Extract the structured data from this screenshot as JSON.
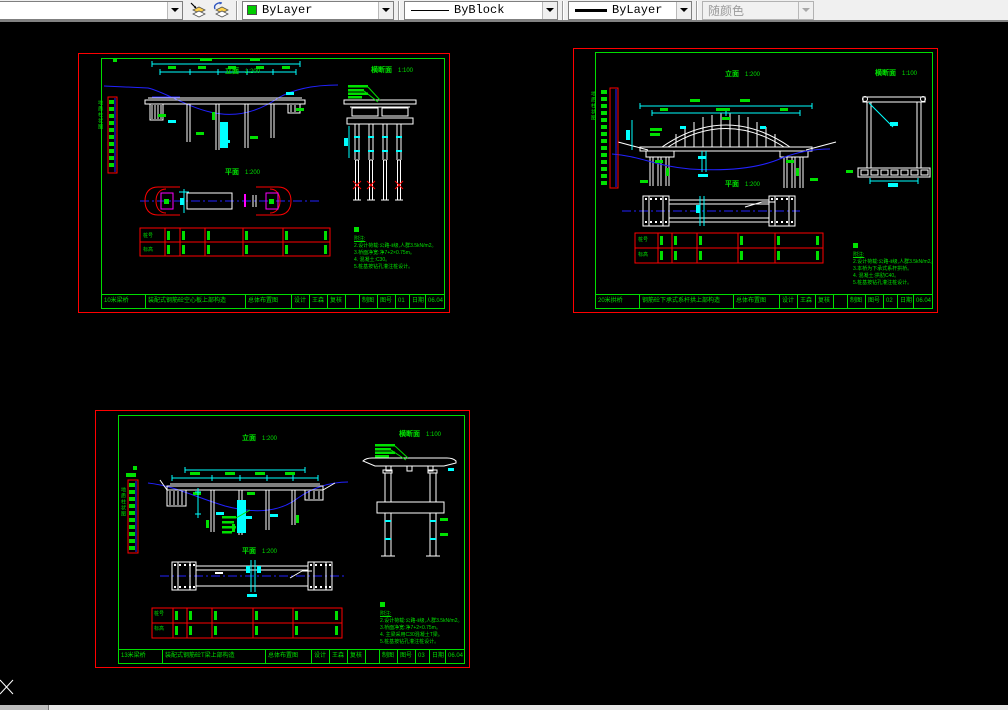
{
  "toolbar": {
    "layer_dropdown": {
      "value": ""
    },
    "color_dropdown": {
      "value": "ByLayer",
      "swatch": "#00CC00"
    },
    "linetype_dropdown": {
      "value": "ByBlock"
    },
    "lineweight_dropdown": {
      "value": "ByLayer"
    },
    "plotstyle_dropdown": {
      "value": "随颜色",
      "disabled": "true"
    }
  },
  "sheets": [
    {
      "elevation_title": "立面",
      "elevation_scale": "1:200",
      "plan_title": "平面",
      "plan_scale": "1:200",
      "section_title": "横断面",
      "section_scale": "1:100",
      "scalebar_text": "地质柱状图",
      "table_row1": "桩号",
      "table_row2": "标高",
      "notes_heading": "附注:",
      "notes": [
        "2.设计荷载:公路-Ⅱ级,人群3.5kN/m2。",
        "3.桥面净宽:净7+2×0.75m。",
        "4.  混凝土:C30。",
        "5.桩基按钻孔灌注桩设计。"
      ],
      "titleblock": {
        "c1": "10米梁桥",
        "c2": "装配式钢筋砼空心板上部构造",
        "c3": "总体布置图",
        "c4": "设计",
        "c5": "王森",
        "c6": "复核",
        "c7": "制图",
        "c8": "图号",
        "c9": "01",
        "c10": "日期",
        "c11": "06.04"
      }
    },
    {
      "elevation_title": "立面",
      "elevation_scale": "1:200",
      "plan_title": "平面",
      "plan_scale": "1:200",
      "section_title": "横断面",
      "section_scale": "1:100",
      "scalebar_text": "地质柱状图",
      "table_row1": "桩号",
      "table_row2": "标高",
      "notes_heading": "附注:",
      "notes": [
        "2.设计荷载:公路-Ⅱ级,人群3.5kN/m2。",
        "3.本桥为下承式系杆拱桥。",
        "4.  混凝土:拱肋C40。",
        "5.桩基按钻孔灌注桩设计。"
      ],
      "titleblock": {
        "c1": "20米拱桥",
        "c2": "钢筋砼下承式系杆拱上部构造",
        "c3": "总体布置图",
        "c4": "设计",
        "c5": "王森",
        "c6": "复核",
        "c7": "制图",
        "c8": "图号",
        "c9": "02",
        "c10": "日期",
        "c11": "06.04"
      }
    },
    {
      "elevation_title": "立面",
      "elevation_scale": "1:200",
      "plan_title": "平面",
      "plan_scale": "1:200",
      "section_title": "横断面",
      "section_scale": "1:100",
      "scalebar_text": "地质柱状图",
      "table_row1": "桩号",
      "table_row2": "标高",
      "notes_heading": "附注:",
      "notes": [
        "2.设计荷载:公路-Ⅱ级,人群3.5kN/m2。",
        "3.桥面净宽:净7+2×0.75m。",
        "4.  主梁采用C30混凝土T梁。",
        "5.桩基按钻孔灌注桩设计。"
      ],
      "titleblock": {
        "c1": "13米梁桥",
        "c2": "装配式钢筋砼T梁上部构造",
        "c3": "总体布置图",
        "c4": "设计",
        "c5": "王森",
        "c6": "复核",
        "c7": "制图",
        "c8": "图号",
        "c9": "03",
        "c10": "日期",
        "c11": "06.04"
      }
    }
  ]
}
